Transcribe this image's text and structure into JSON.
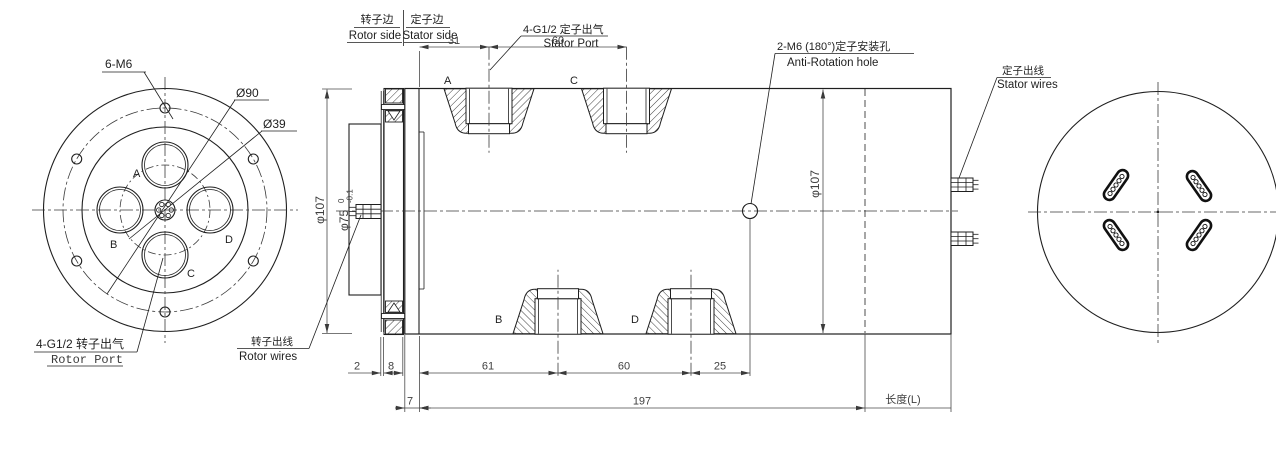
{
  "drawing": {
    "front_view": {
      "labels": {
        "bolt_pattern": "6-M6",
        "bolt_circle_dia": "Ø90",
        "port_circle_dia": "Ø39",
        "rotor_port_cn": "4-G1/2 转子出气",
        "rotor_port_en": "Rotor Port"
      },
      "ports": {
        "a": "A",
        "b": "B",
        "c": "C",
        "d": "D"
      }
    },
    "section_view": {
      "header": {
        "rotor_side_cn": "转子边",
        "rotor_side_en": "Rotor side",
        "stator_side_cn": "定子边",
        "stator_side_en": "Stator side"
      },
      "callouts": {
        "stator_port_cn": "4-G1/2 定子出气",
        "stator_port_en": "Stator Port",
        "anti_rotation_cn": "2-M6 (180°)定子安装孔",
        "anti_rotation_en": "Anti-Rotation hole",
        "stator_wires_cn": "定子出线",
        "stator_wires_en": "Stator wires",
        "rotor_wires_cn": "转子出线",
        "rotor_wires_en": "Rotor wires"
      },
      "dimensions": {
        "top_left_to_a": "31",
        "top_a_to_c": "60",
        "gap": "2",
        "flange": "8",
        "ring": "7",
        "left_to_b": "61",
        "b_to_d": "60",
        "d_to_hole": "25",
        "body_length": "197",
        "total_length": "长度(L)",
        "flange_dia": "φ107",
        "body_dia": "φ107",
        "boss_dia": "φ75",
        "boss_tol_upper": "0",
        "boss_tol_lower": "-0.1"
      },
      "ports": {
        "a": "A",
        "b": "B",
        "c": "C",
        "d": "D"
      }
    }
  }
}
